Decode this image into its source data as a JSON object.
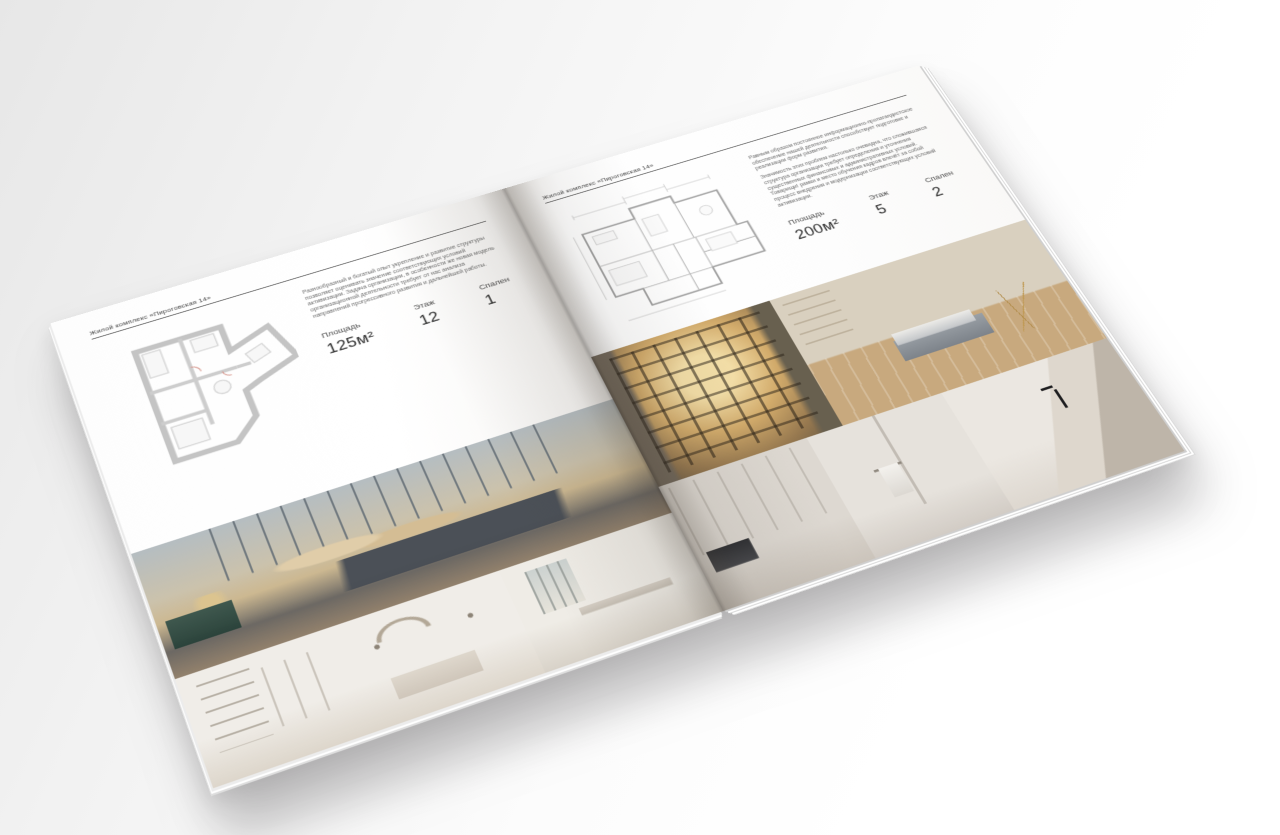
{
  "colors": {
    "surface": "#f2f2f2",
    "page": "#ffffff",
    "text": "#3f3f3f",
    "rule": "#565656",
    "plan_walls": "#c4c4c4",
    "plan_lines": "#a2a2a2",
    "accent_wood": "#c8a97e",
    "accent_teal": "#3f584e"
  },
  "left_page": {
    "header": "Жилой комплекс «Пироговская 14»",
    "paragraph": "Разнообразный и богатый опыт укрепление и развитие структуры позволяет оценивать значение соответствующих условий активизации. Задача организации, в особенности же новая модель организационной деятельности требует от нас анализа направлений прогрессивного развития и дальнейшей работы.",
    "stats": [
      {
        "label": "Площадь",
        "value": "125м²"
      },
      {
        "label": "Этаж",
        "value": "12"
      },
      {
        "label": "Спален",
        "value": "1"
      }
    ],
    "floor_plan": "floor-plan-1-bedroom-apartment",
    "photos": [
      "master-bedroom-with-city-view",
      "white-bedroom-with-shelving",
      "dressing-room-with-window"
    ]
  },
  "right_page": {
    "header": "Жилой комплекс «Пироговская 14»",
    "paragraphs": [
      "Равным образом постоянное информационно-пропагандистское обеспечение нашей деятельности способствует подготовке и реализации форм развития.",
      "Значимость этих проблем настолько очевидна, что сложившаяся структура организации требует определения и уточнения существенных финансовых и административных условий. Товарищи! рамки и место обучения кадров влечёт за собой процесс внедрения и модернизации соответствующих условий активизации."
    ],
    "stats": [
      {
        "label": "Площадь",
        "value": "200м²"
      },
      {
        "label": "Этаж",
        "value": "5"
      },
      {
        "label": "Спален",
        "value": "2"
      }
    ],
    "floor_plan": "floor-plan-2-bedroom-apartment",
    "photos": [
      "wardrobe-with-lit-shelves",
      "living-room-with-daybed",
      "kitchen-corridor",
      "bathroom-with-towel",
      "marble-sink-detail"
    ]
  }
}
